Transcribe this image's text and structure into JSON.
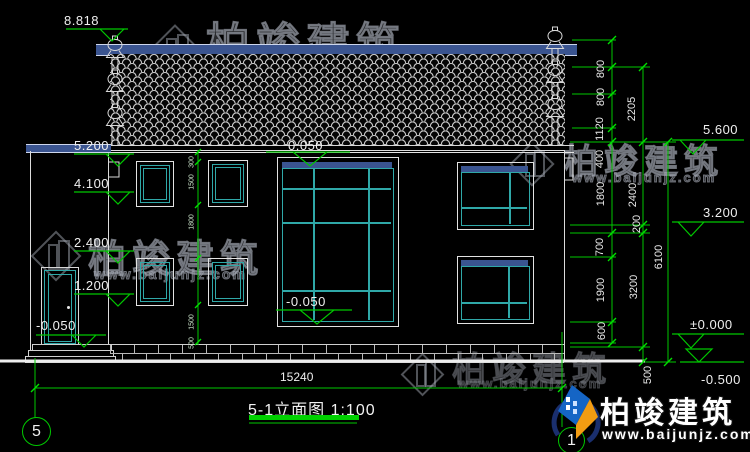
{
  "watermark": {
    "brand": "柏竣建筑",
    "url": "www.baijunjz.com"
  },
  "title": {
    "label": "5-1立面图 1:100"
  },
  "axes": {
    "left": "5",
    "right": "1"
  },
  "elevations": {
    "left": [
      "8.818",
      "5.200",
      "4.100",
      "2.400",
      "1.200",
      "-0.050"
    ],
    "center": [
      "0.050",
      "-0.050"
    ],
    "right": [
      "5.600",
      "3.200",
      "±0.000",
      "-0.500"
    ]
  },
  "dims": {
    "inner": [
      "800",
      "800",
      "1120",
      "400",
      "1800",
      "700",
      "1900",
      "600"
    ],
    "mid": [
      "2205",
      "2400",
      "200",
      "3200",
      "500"
    ],
    "total_height": "6100",
    "total_width": "15240",
    "window": [
      "300",
      "1500",
      "1800",
      "1500",
      "500"
    ]
  }
}
